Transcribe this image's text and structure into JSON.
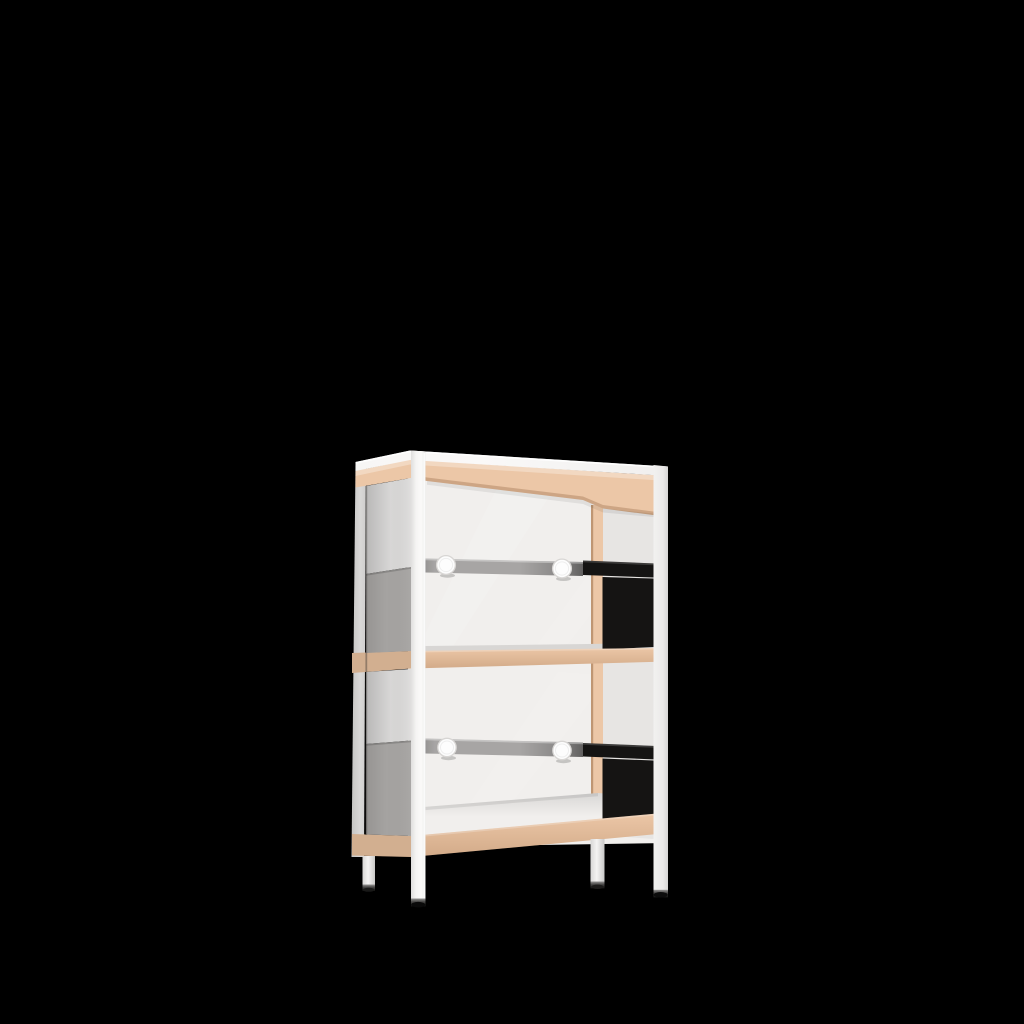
{
  "scene": {
    "type": "3d-product-render",
    "subject": "Two-tier storage shelf unit with a white frame and legs, beech wood aprons and shelf bands, smoked grey lower side panels, clear upper side panels, black inner side panels, and a grey hanging rail with two round white knobs on each level",
    "shelf_levels": 2,
    "rails": 2,
    "knobs_per_rail": 2,
    "legs": 4,
    "colors": {
      "background": "#000000",
      "frame_white": "#f3f2f1",
      "wood_beech": "#ecc7a7",
      "back_panel_white": "#f1efed",
      "side_panel_grey": "#a5a3a1",
      "glass_tint": "#dcdbda",
      "inner_panel_black": "#151413",
      "rail_grey": "#a7a5a4",
      "knob_white": "#fdfdfd",
      "foot_cap_dark": "#0d0d0d"
    }
  }
}
